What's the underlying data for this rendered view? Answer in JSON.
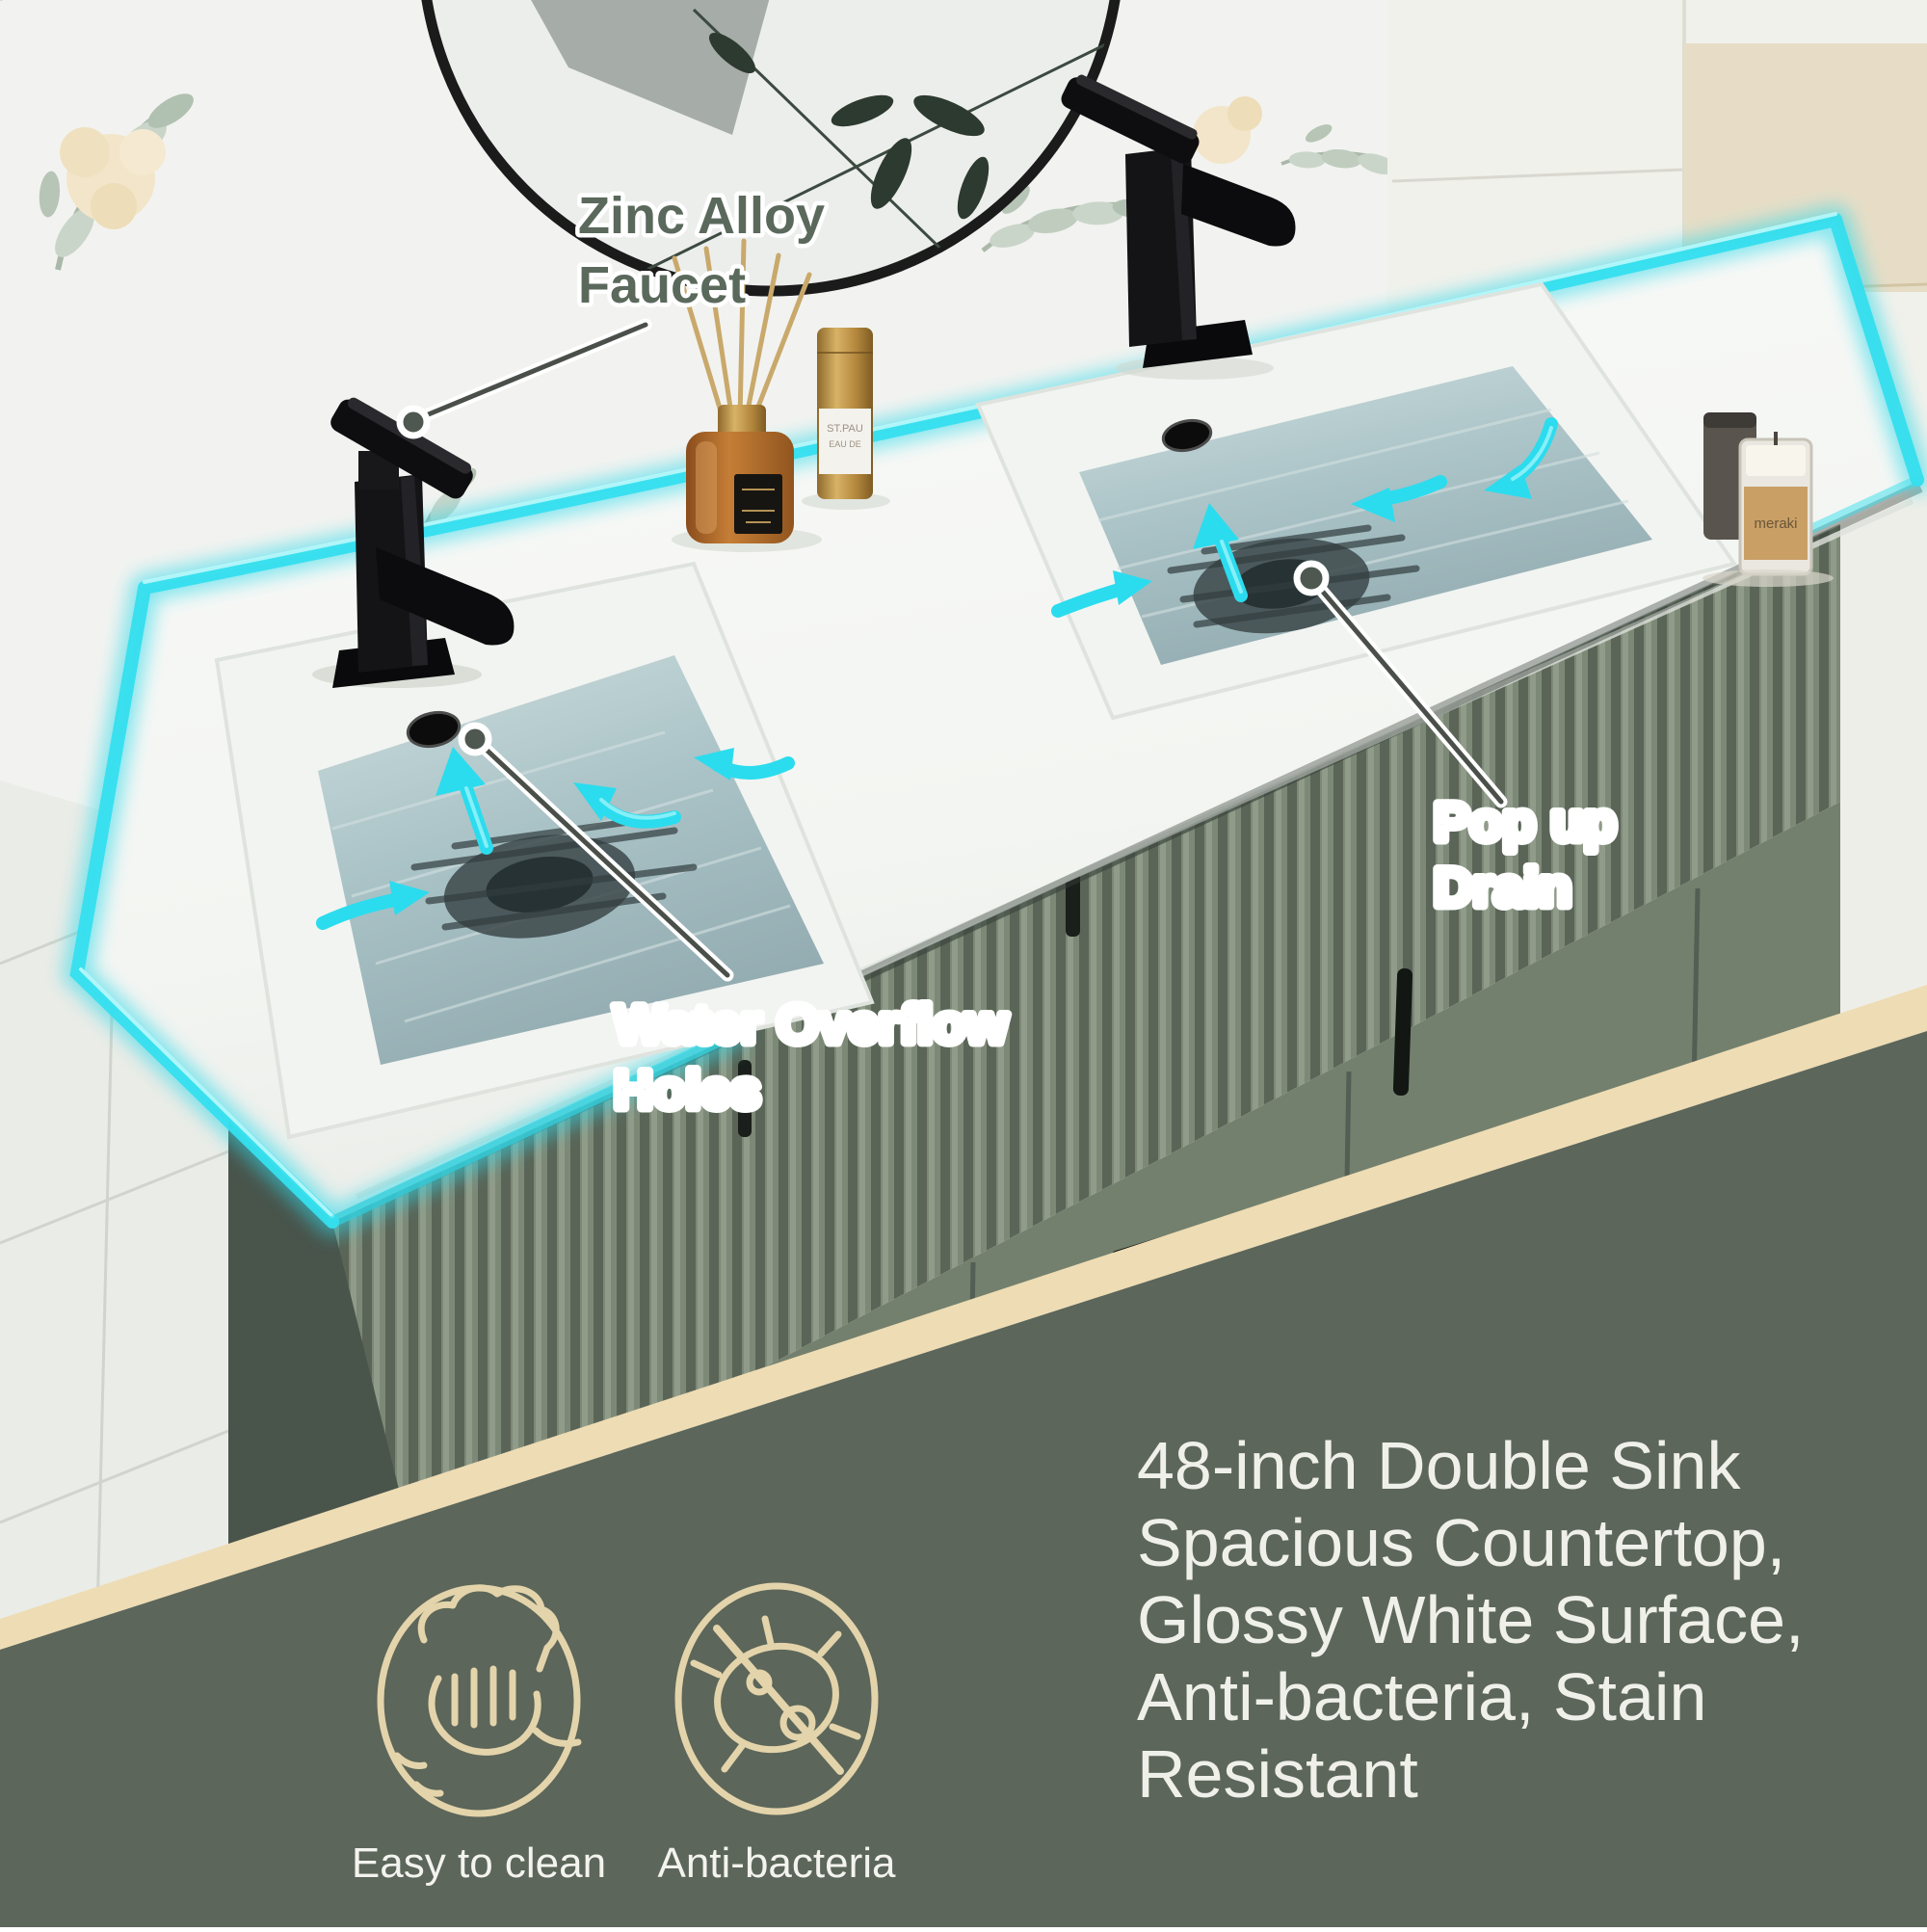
{
  "image_type": "product-infographic-bathroom-vanity",
  "callouts": {
    "faucet": {
      "line1": "Zinc Alloy",
      "line2": "Faucet"
    },
    "overflow": {
      "line1": "Water Overflow",
      "line2": "Holes"
    },
    "drain": {
      "line1": "Pop up",
      "line2": "Drain"
    }
  },
  "bottom_panel": {
    "headline_lines": [
      "48-inch Double Sink",
      "Spacious Countertop,",
      "Glossy White Surface,",
      "Anti-bacteria, Stain",
      "Resistant"
    ],
    "features": [
      {
        "icon": "hand-wipe-icon",
        "label": "Easy to clean"
      },
      {
        "icon": "no-bacteria-icon",
        "label": "Anti-bacteria"
      }
    ]
  },
  "decor_labels": {
    "candle": "meraki",
    "perfume_line1": "ST.PAU",
    "perfume_line2": "EAU DE"
  },
  "colors": {
    "accent_cyan": "#35dfee",
    "band_beige": "#eedcb4",
    "panel_green": "#5c665a",
    "cabinet_green": "#6d7968",
    "callout_text_green": "#5a695c",
    "icon_cream": "#e4d4ab",
    "water_blue": "#aac3c7"
  }
}
